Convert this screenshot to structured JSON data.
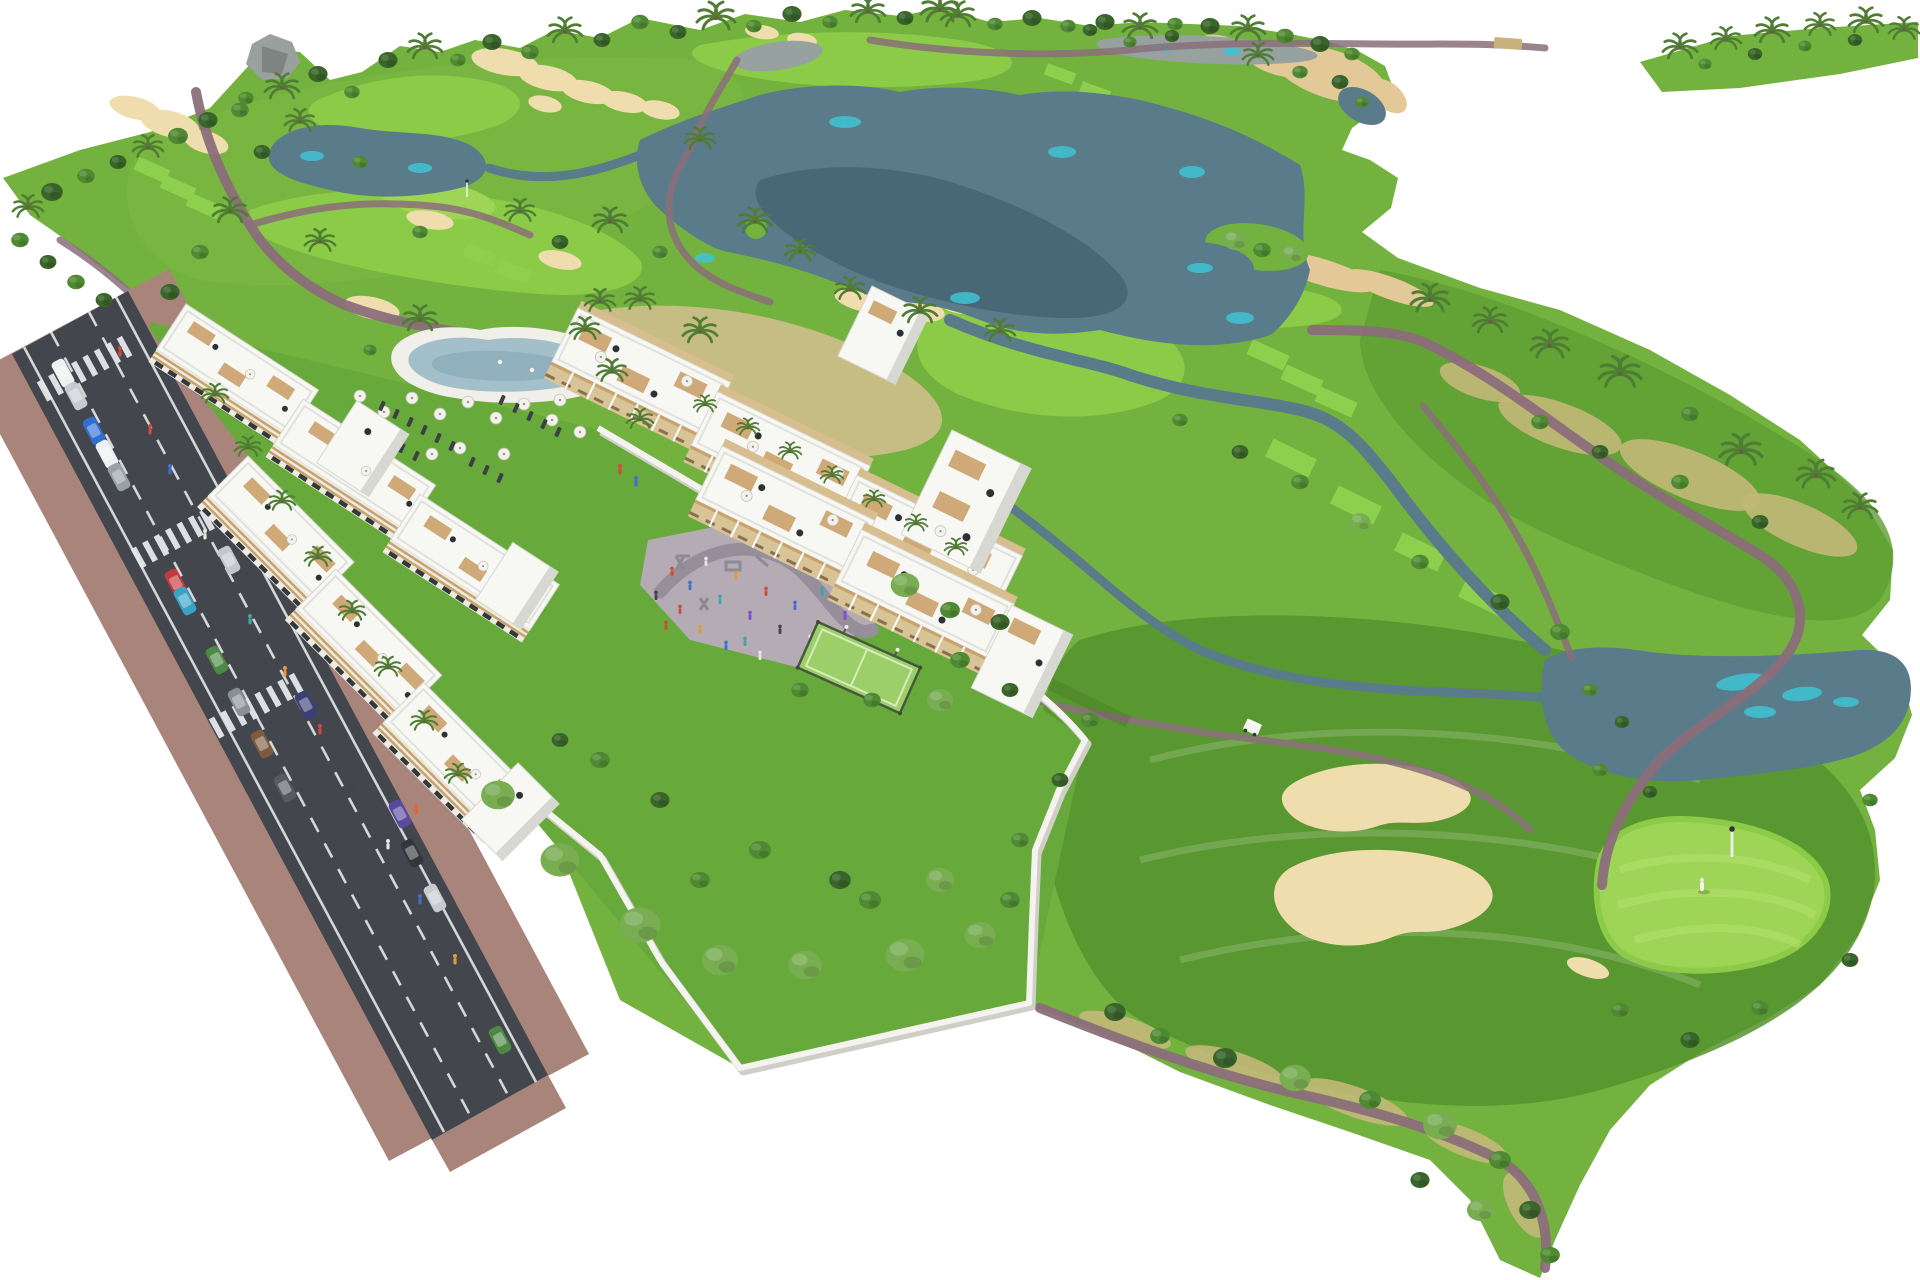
{
  "scene": {
    "description": "Aerial 3D architectural rendering of a golf resort residential complex: white low-rise apartment buildings with rooftop wood-deck terraces, a lagoon swimming pool with sun umbrellas, a playground plaza, a fenced padel court and walled private gardens, all set beside an 18-hole golf course with slate-blue lakes, cream sand bunkers, winding mauve cart paths, palm trees and a boulevard with parked and driving cars.",
    "background": "#ffffff",
    "areas": [
      {
        "id": "golf-course",
        "label": "golf course with rough, fairways, tee boxes and putting greens"
      },
      {
        "id": "lakes",
        "label": "irregular slate-blue lakes with turquoise shallows and tree islands"
      },
      {
        "id": "sand-bunkers",
        "label": "cream colored sand bunkers and waste areas"
      },
      {
        "id": "cart-paths",
        "label": "winding mauve-brown cart paths with a small bridge"
      },
      {
        "id": "palm-hill",
        "label": "palm covered hill with dry scrub on the east side"
      },
      {
        "id": "apartment-building-a",
        "label": "stepped white apartment slab along the road with roof terraces"
      },
      {
        "id": "apartment-building-b",
        "label": "second stepped white apartment slab with garden"
      },
      {
        "id": "apartment-row-upper-east",
        "label": "upper east residential row with pergola terraces"
      },
      {
        "id": "apartment-row-lower-east",
        "label": "lower east residential row with pergola terraces"
      },
      {
        "id": "lagoon-pool",
        "label": "curvy lagoon pool with white deck, umbrellas and loungers"
      },
      {
        "id": "playground-plaza",
        "label": "paved plaza with playground equipment and people"
      },
      {
        "id": "padel-court",
        "label": "green fenced padel court"
      },
      {
        "id": "private-gardens",
        "label": "walled gardens with large trees"
      },
      {
        "id": "access-road",
        "label": "diagonal asphalt boulevard with dashed lanes, crosswalks, parking lane and sidewalks"
      },
      {
        "id": "bottom-green",
        "label": "south-east golf hole with double bunker, putting green, flag and golfer"
      }
    ],
    "counts": {
      "crosswalks": 3,
      "golf_flags": 2,
      "pools": 1,
      "padel_courts": 1,
      "golf_carts": 1
    },
    "vehicles": {
      "parked_cars": 11,
      "driving_cars": 6,
      "golf_carts": 1
    }
  },
  "palette": {
    "bg": "#ffffff",
    "grass": "#74b23f",
    "grassLight": "#7eb944",
    "grassDark": "#5f9e33",
    "grassDeep": "#55922e",
    "garden": "#67a93a",
    "fairway": "#8ccb47",
    "green": "#9ed556",
    "tee": "#8ed04d",
    "sand": "#efddad",
    "sandDeep": "#e4c998",
    "scrub": "#c2b878",
    "dry": "#c6bd84",
    "water": "#5a7b8a",
    "waterDeep": "#486878",
    "cyan": "#3ec3d3",
    "marsh": "#96a1a0",
    "path": "#8b6e7a",
    "rock": "#9aa09e",
    "road": "#43474d",
    "line": "#e4e6e8",
    "sidewalk": "#a9847b",
    "bldg": "#f7f7f4",
    "bldgShadow": "#d8d8d2",
    "parapet": "#e2e2dc",
    "facade": "#edebe3",
    "wood": "#c8a26b",
    "deck": "#cfa977",
    "win": "#34383b",
    "dark": "#2e3133",
    "treeDark": "#3a652a",
    "treeMid": "#4f8a33",
    "treeLight": "#78ad52",
    "treePale": "#9cc47c",
    "palm": "#4e7d33",
    "umb": "#f3f2ec",
    "umbRim": "#c9c7bf",
    "plaza": "#b4abb5",
    "plazaPath": "#968e9a",
    "court": "#9ccf69",
    "courtLine": "#d8ecba",
    "fence": "#46583f",
    "pool": "#a3bfc9",
    "poolDeep": "#8fb0bc",
    "flagpole": "#eceff0"
  }
}
